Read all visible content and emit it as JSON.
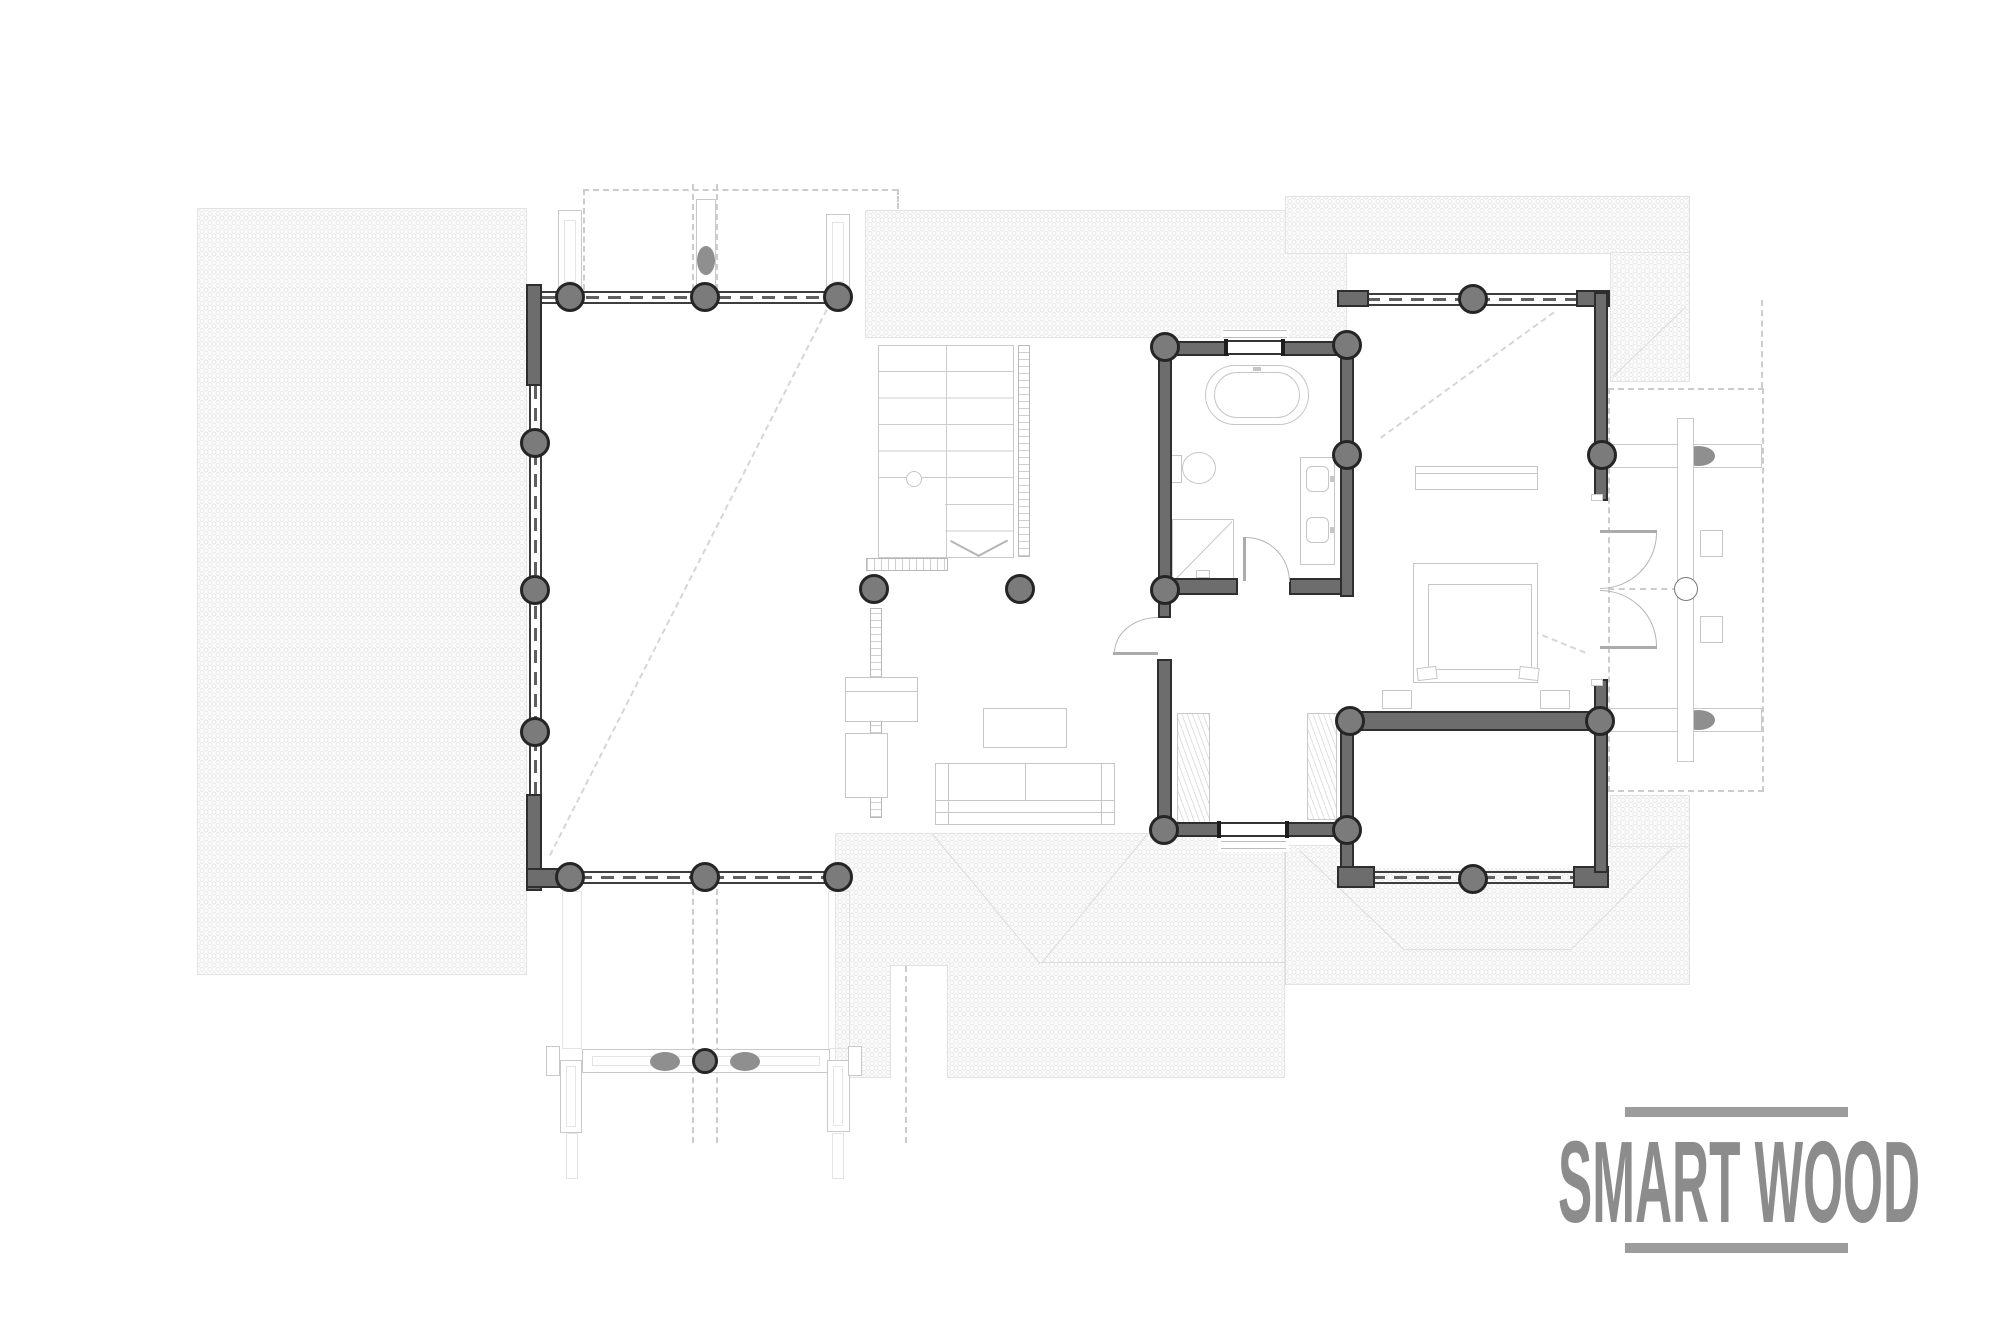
{
  "brand": {
    "name": "SMART WOOD"
  },
  "palette": {
    "wall": "#6d6d6d",
    "wall_border": "#2e2e2e",
    "col": "#7b7b7b",
    "col_border": "#252525",
    "hatch": "#e8e8e8",
    "line_light": "#c9c9c9",
    "line_furn": "#c6c6c6",
    "line_dash": "#cccccc",
    "line_roof": "#dcdcdc",
    "brand": "#8c8c8c"
  },
  "legend": {
    "icons": [
      "roof-hatch",
      "eaves-dashed",
      "round-column",
      "oval-column",
      "window-band",
      "window",
      "door-swing",
      "staircase",
      "railing",
      "bathtub",
      "toilet",
      "shower",
      "double-sink-vanity",
      "wardrobe",
      "double-bed",
      "nightstand",
      "dresser",
      "sofa",
      "coffee-table",
      "tv-cabinet",
      "round-table"
    ]
  }
}
